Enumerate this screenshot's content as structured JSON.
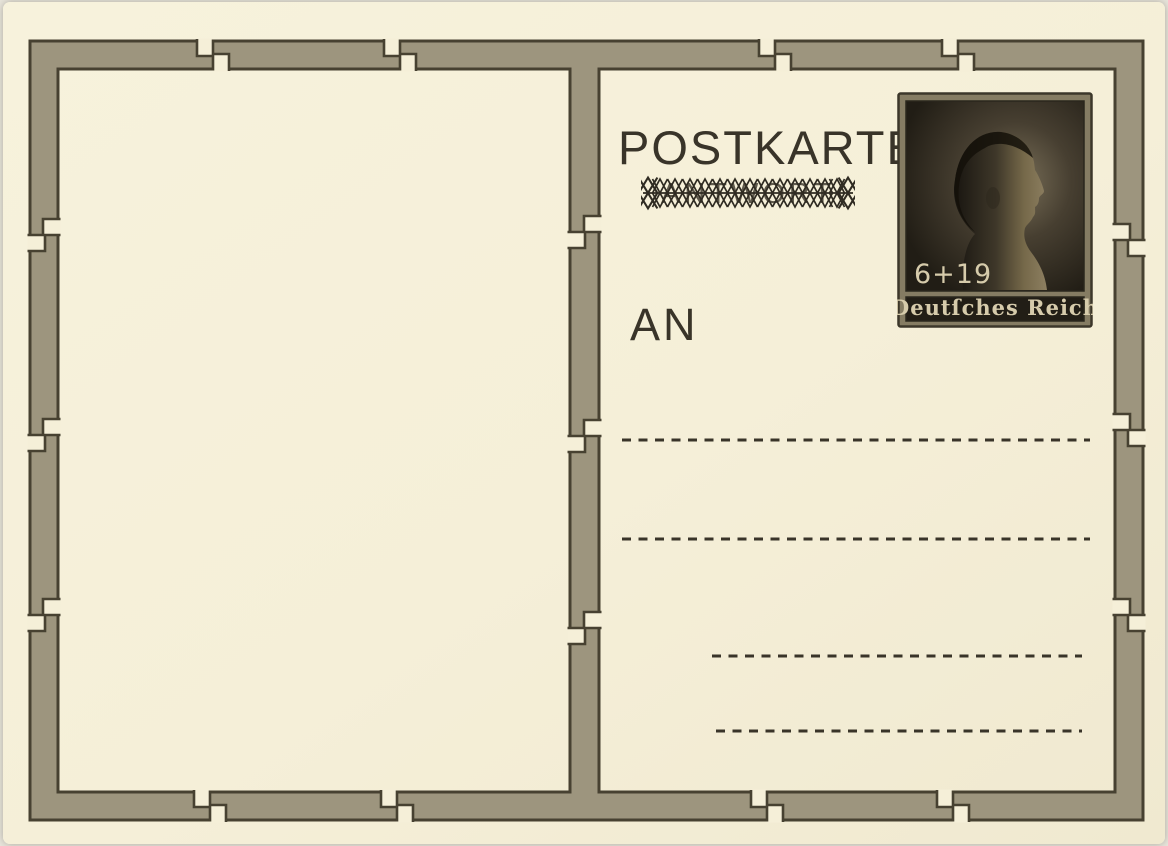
{
  "card": {
    "title": "POSTKARTE",
    "reply_label": "ANTWORT",
    "address_prefix": "AN",
    "address_line_count": 4
  },
  "stamp": {
    "value": "6+19",
    "country": "Deutſches Reich"
  },
  "colors": {
    "page_background": "#e9e6dc",
    "card_background": "#f5efd8",
    "frame_band": "#9d957e",
    "frame_outline": "#474131",
    "ink": "#393429",
    "stamp_frame": "#857c63",
    "stamp_field": "#241f17",
    "stamp_text": "#d6cbab"
  }
}
